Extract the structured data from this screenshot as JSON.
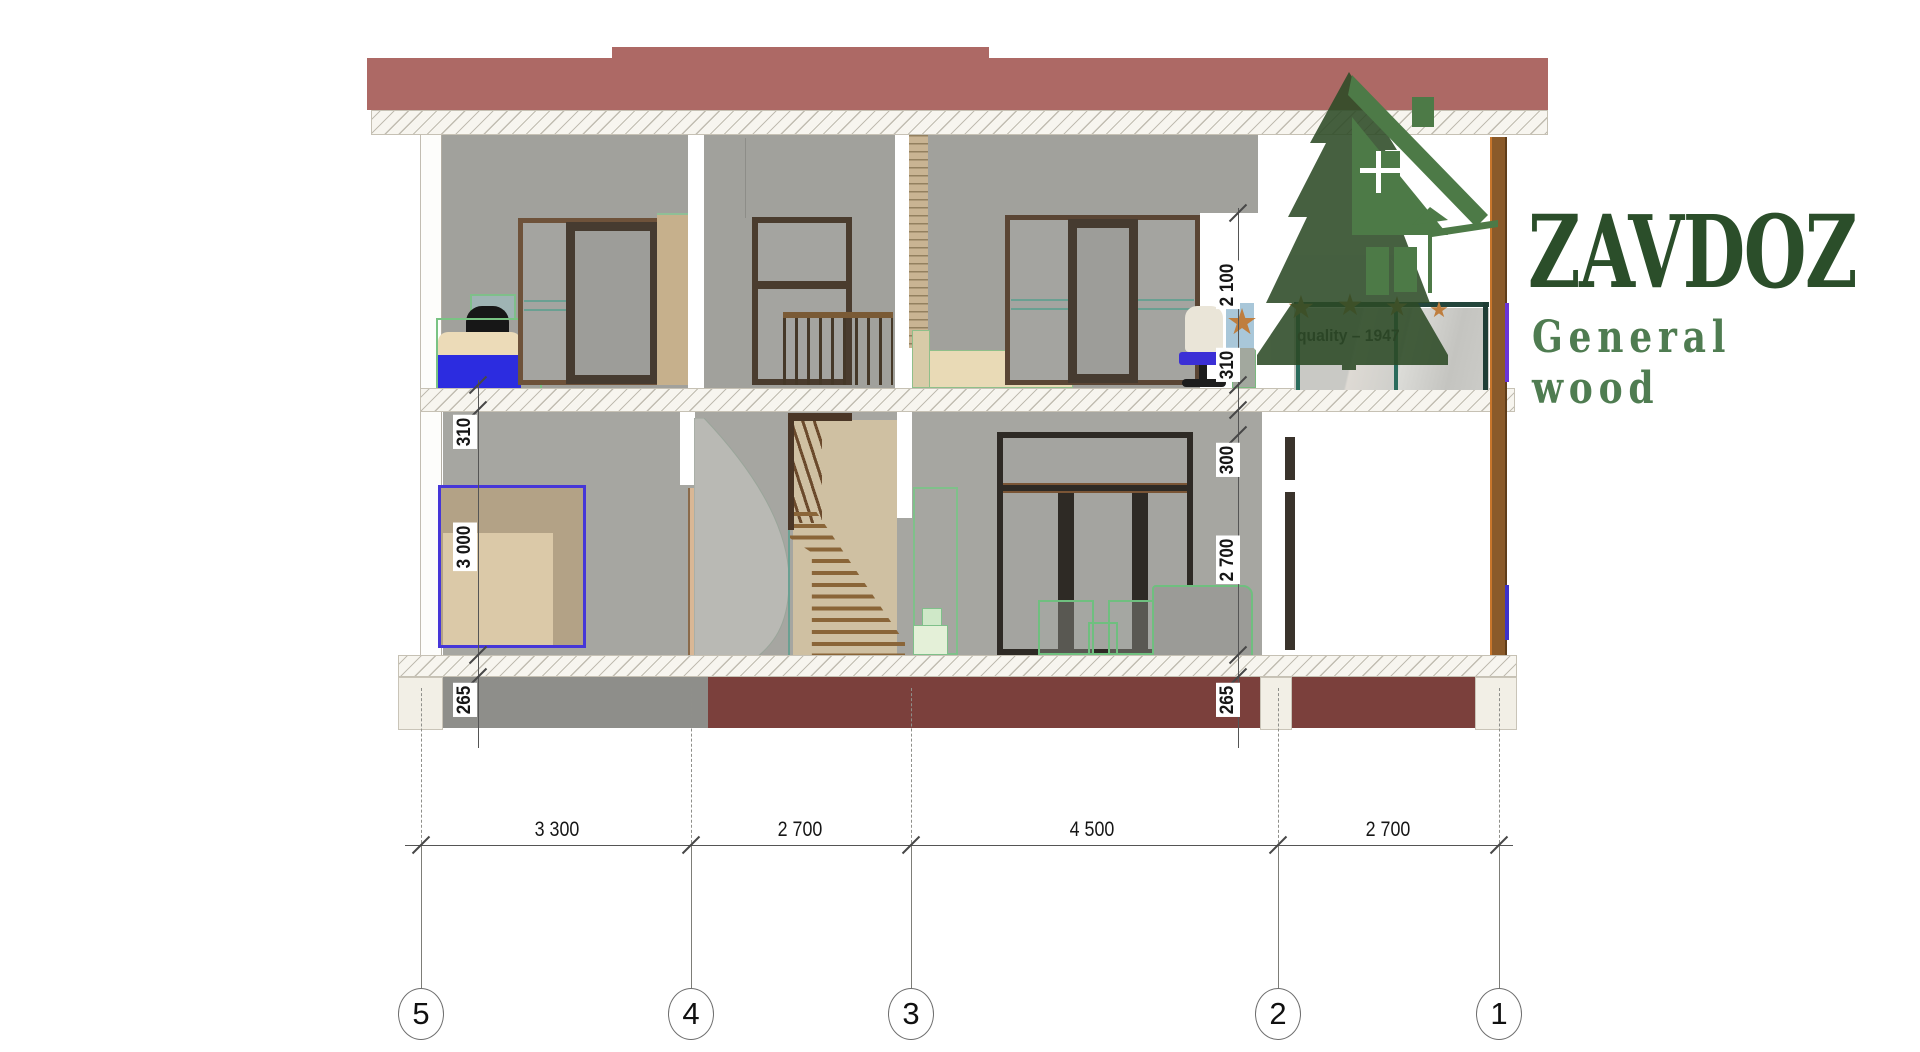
{
  "logo": {
    "brand": "ZAVDOZ",
    "subtitle": "General wood",
    "tagline": "quality – 1947"
  },
  "icons": {
    "star": "★"
  },
  "grid_bubbles": [
    "5",
    "4",
    "3",
    "2",
    "1"
  ],
  "dims": {
    "bottom": [
      "3 300",
      "2 700",
      "4 500",
      "2 700"
    ],
    "left": [
      "310",
      "3 000",
      "265"
    ],
    "right": [
      "2 100",
      "310",
      "300",
      "2 700",
      "265"
    ]
  },
  "colors": {
    "roof_red": "#ad6965",
    "wall_gray": "#a1a19c",
    "foundation_maroon": "#7b403c",
    "logo_dark_green": "#2b4e2a",
    "logo_mid_green": "#4f7c51",
    "star_orange": "#bf7e3e",
    "accent_blue": "#3b2fd6"
  }
}
